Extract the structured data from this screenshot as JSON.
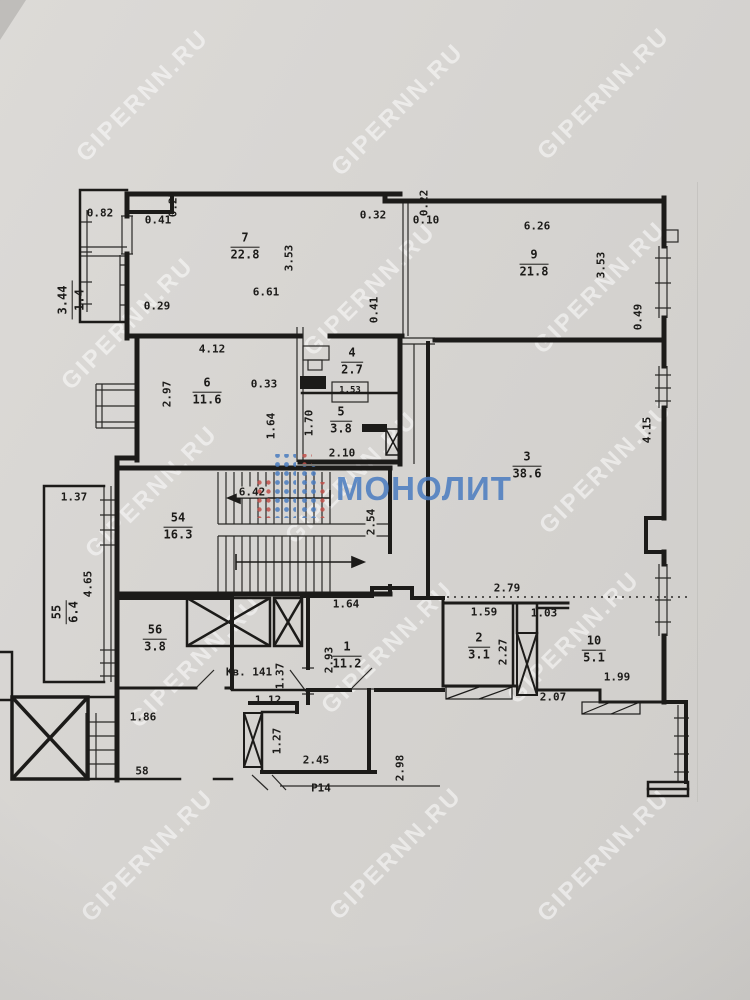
{
  "colors": {
    "paper": "#d6d4d0",
    "ink": "#1c1b19",
    "watermark": "rgba(255,255,255,0.52)",
    "logo_blue": "#4a7cc0",
    "logo_red": "#c2504a"
  },
  "watermark": {
    "text": "GIPERNN.RU",
    "positions": [
      [
        143,
        96
      ],
      [
        398,
        110
      ],
      [
        604,
        94
      ],
      [
        128,
        324
      ],
      [
        370,
        290
      ],
      [
        600,
        288
      ],
      [
        152,
        492
      ],
      [
        352,
        478
      ],
      [
        606,
        468
      ],
      [
        196,
        662
      ],
      [
        388,
        648
      ],
      [
        574,
        638
      ],
      [
        148,
        856
      ],
      [
        396,
        854
      ],
      [
        604,
        856
      ]
    ]
  },
  "logo": {
    "text": "МОНОЛИТ"
  },
  "rooms": [
    {
      "num": "7",
      "area": "22.8",
      "x": 245,
      "y": 247
    },
    {
      "num": "9",
      "area": "21.8",
      "x": 534,
      "y": 264
    },
    {
      "num": "6",
      "area": "11.6",
      "x": 207,
      "y": 392
    },
    {
      "num": "4",
      "area": "2.7",
      "x": 352,
      "y": 362
    },
    {
      "num": "5",
      "area": "3.8",
      "x": 341,
      "y": 421
    },
    {
      "num": "3",
      "area": "38.6",
      "x": 527,
      "y": 466
    },
    {
      "num": "54",
      "area": "16.3",
      "x": 178,
      "y": 527
    },
    {
      "num": "55",
      "area": "6.4",
      "x": 66,
      "y": 612,
      "r": -90
    },
    {
      "num": "56",
      "area": "3.8",
      "x": 155,
      "y": 639
    },
    {
      "num": "1",
      "area": "11.2",
      "x": 347,
      "y": 656
    },
    {
      "num": "2",
      "area": "3.1",
      "x": 479,
      "y": 647
    },
    {
      "num": "10",
      "area": "5.1",
      "x": 594,
      "y": 650
    },
    {
      "num": "3.44",
      "area": "1.4",
      "x": 72,
      "y": 300,
      "r": -90
    }
  ],
  "dims": [
    {
      "t": "0.82",
      "x": 100,
      "y": 213
    },
    {
      "t": "0.41",
      "x": 158,
      "y": 220
    },
    {
      "t": "0.27",
      "x": 173,
      "y": 204,
      "r": -90
    },
    {
      "t": "0.29",
      "x": 157,
      "y": 306
    },
    {
      "t": "3.53",
      "x": 289,
      "y": 258,
      "r": -90
    },
    {
      "t": "6.61",
      "x": 266,
      "y": 292
    },
    {
      "t": "0.32",
      "x": 373,
      "y": 215
    },
    {
      "t": "0.22",
      "x": 424,
      "y": 203,
      "r": -90
    },
    {
      "t": "0.10",
      "x": 426,
      "y": 220
    },
    {
      "t": "6.26",
      "x": 537,
      "y": 226
    },
    {
      "t": "3.53",
      "x": 601,
      "y": 265,
      "r": -90
    },
    {
      "t": "0.49",
      "x": 638,
      "y": 317,
      "r": -90
    },
    {
      "t": "0.41",
      "x": 374,
      "y": 310,
      "r": -90
    },
    {
      "t": "4.12",
      "x": 212,
      "y": 349
    },
    {
      "t": "2.97",
      "x": 167,
      "y": 394,
      "r": -90
    },
    {
      "t": "0.33",
      "x": 264,
      "y": 384
    },
    {
      "t": "1.64",
      "x": 271,
      "y": 426,
      "r": -90
    },
    {
      "t": "1.53",
      "x": 350,
      "y": 391,
      "fs": 9
    },
    {
      "t": "2.10",
      "x": 342,
      "y": 453
    },
    {
      "t": "1.70",
      "x": 309,
      "y": 423,
      "r": -90
    },
    {
      "t": "4.15",
      "x": 647,
      "y": 430,
      "r": -90
    },
    {
      "t": "2.79",
      "x": 507,
      "y": 588
    },
    {
      "t": "6.42",
      "x": 252,
      "y": 492,
      "bg": 1
    },
    {
      "t": "2.54",
      "x": 371,
      "y": 522,
      "r": -90,
      "bg": 1
    },
    {
      "t": "1.64",
      "x": 346,
      "y": 604
    },
    {
      "t": "1.37",
      "x": 74,
      "y": 497
    },
    {
      "t": "4.65",
      "x": 88,
      "y": 584,
      "r": -90
    },
    {
      "t": "1.86",
      "x": 143,
      "y": 717
    },
    {
      "t": "58",
      "x": 142,
      "y": 771
    },
    {
      "t": "Кв. 141",
      "x": 249,
      "y": 672
    },
    {
      "t": "1.37",
      "x": 280,
      "y": 676,
      "r": -90
    },
    {
      "t": "1.12",
      "x": 268,
      "y": 700
    },
    {
      "t": "2.93",
      "x": 329,
      "y": 660,
      "r": -90
    },
    {
      "t": "1.27",
      "x": 277,
      "y": 741,
      "r": -90
    },
    {
      "t": "2.45",
      "x": 316,
      "y": 760
    },
    {
      "t": "Р14",
      "x": 321,
      "y": 788
    },
    {
      "t": "2.98",
      "x": 400,
      "y": 768,
      "r": -90
    },
    {
      "t": "1.59",
      "x": 484,
      "y": 612
    },
    {
      "t": "1.03",
      "x": 544,
      "y": 613
    },
    {
      "t": "2.27",
      "x": 503,
      "y": 652,
      "r": -90
    },
    {
      "t": "1.99",
      "x": 617,
      "y": 677
    },
    {
      "t": "2.07",
      "x": 553,
      "y": 697
    }
  ]
}
